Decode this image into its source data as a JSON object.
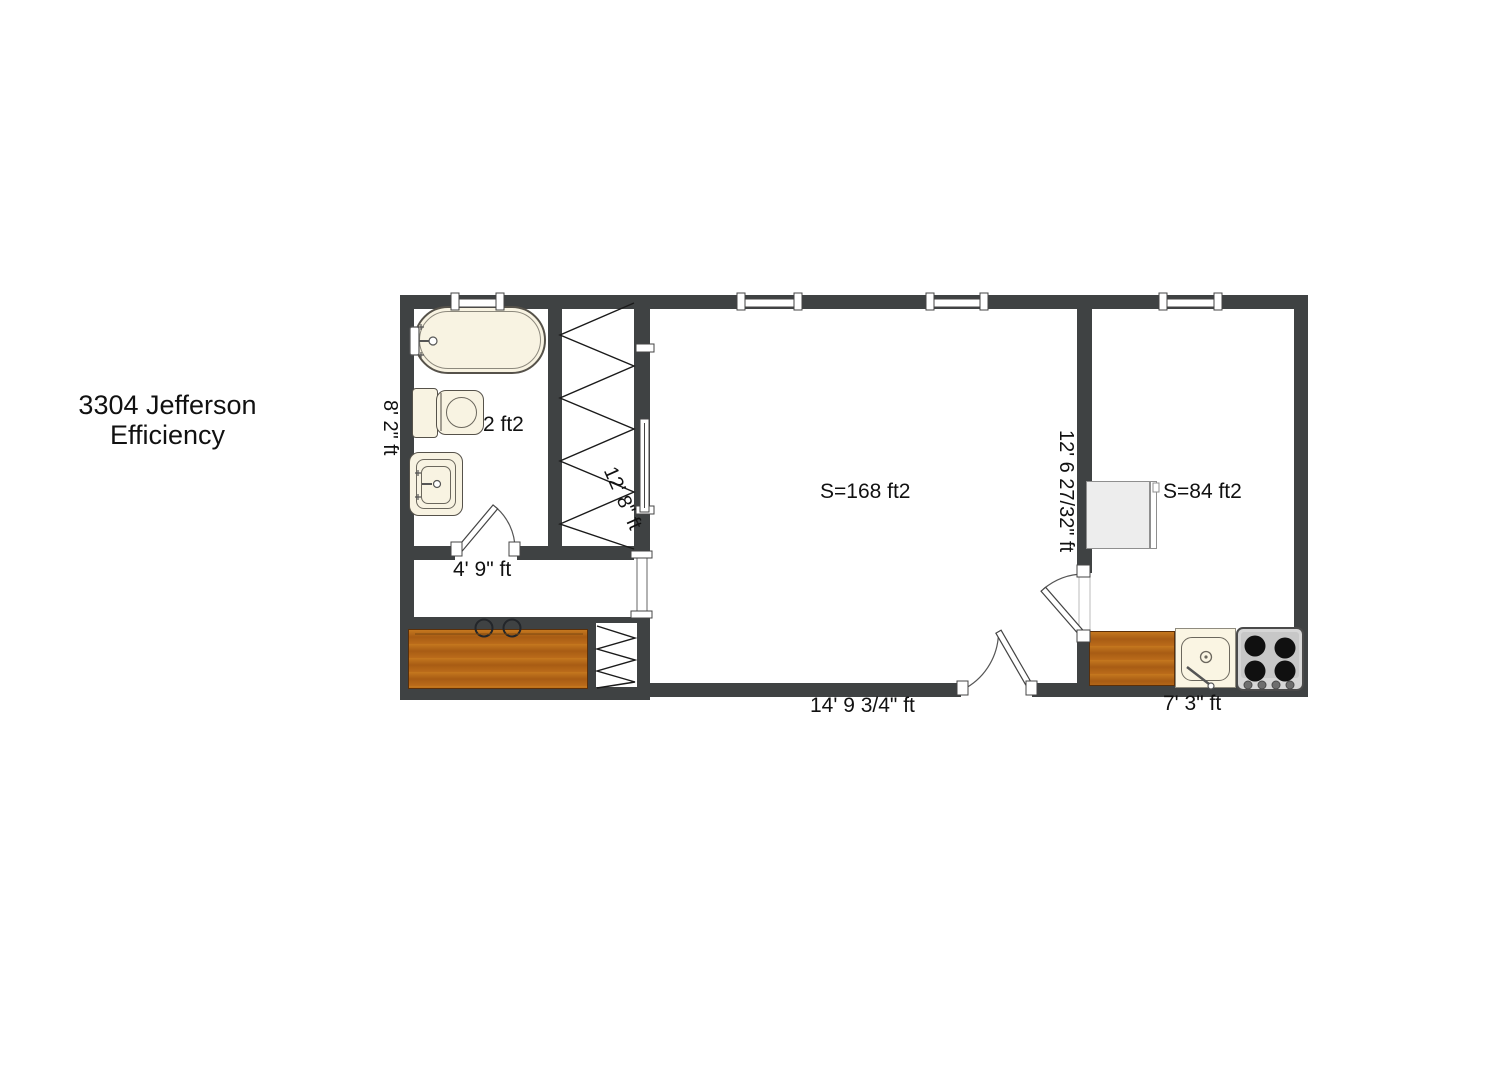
{
  "title": {
    "line1": "3304 Jefferson",
    "line2": "Efficiency"
  },
  "plan": {
    "bathroom": {
      "area_label": "2 ft2",
      "height_dim": "8' 2\" ft",
      "fixtures": [
        "bathtub",
        "toilet",
        "sink"
      ]
    },
    "hallway": {
      "width_dim": "4' 9\" ft"
    },
    "closet": {
      "depth_dim": "12' 8\" ft"
    },
    "main_room": {
      "area_label": "S=168 ft2",
      "width_dim": "14' 9 3/4\" ft"
    },
    "kitchen": {
      "area_label": "S=84 ft2",
      "height_dim": "12' 6 27/32\" ft",
      "width_dim": "7' 3\" ft",
      "fixtures": [
        "refrigerator",
        "counter",
        "sink",
        "stove"
      ]
    },
    "colors": {
      "wall": "#3f4243",
      "wood_counter": "#b9671c",
      "fixture_fill": "#f8f3e2",
      "stove_body": "#d6d6d6",
      "refrigerator": "#ededed",
      "text": "#111111"
    }
  }
}
